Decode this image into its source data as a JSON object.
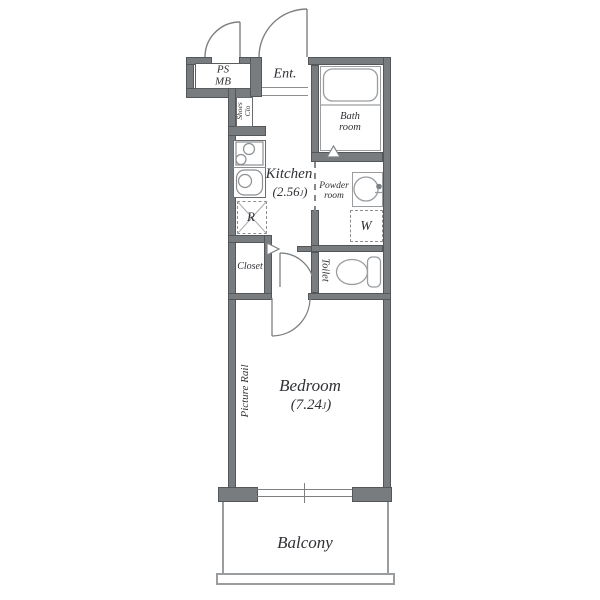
{
  "title": "apartment-floor-plan",
  "rooms": {
    "ps_mb": {
      "line1": "PS",
      "line2": "MB"
    },
    "entrance": {
      "label": "Ent."
    },
    "shoes_closet": {
      "line1": "Shoes",
      "line2": "Clo"
    },
    "bathroom": {
      "line1": "Bath",
      "line2": "room"
    },
    "kitchen": {
      "label": "Kitchen",
      "size_open": "(2.56",
      "size_unit": "J",
      "size_close": ")"
    },
    "refrigerator": {
      "label": "R"
    },
    "powder_room": {
      "line1": "Powder",
      "line2": "room"
    },
    "washer": {
      "label": "W"
    },
    "closet": {
      "label": "Closet"
    },
    "toilet": {
      "label": "Toilet"
    },
    "bedroom": {
      "label": "Bedroom",
      "size_open": "(7.24",
      "size_unit": "J",
      "size_close": ")"
    },
    "picture_rail": {
      "label": "Picture Rail"
    },
    "balcony": {
      "label": "Balcony"
    }
  },
  "colors": {
    "wall": "#797c7f",
    "wall_edge": "#54575a",
    "line": "#8b8f92",
    "fixture": "#9a9da0",
    "door": "#7d8083",
    "text": "#2f3136"
  }
}
